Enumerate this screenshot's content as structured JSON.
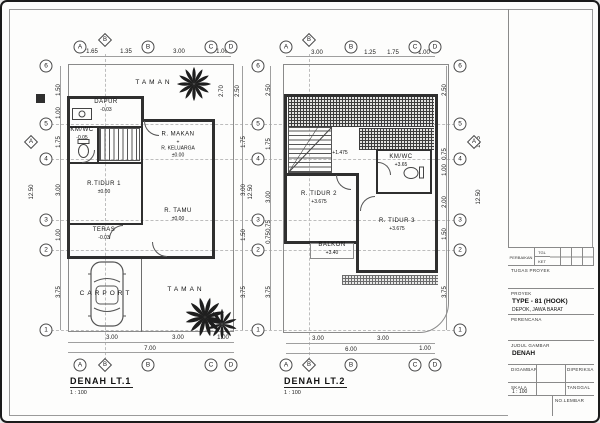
{
  "drawing": {
    "plans": [
      {
        "name": "floor-plan-level-1",
        "title": "DENAH LT.1",
        "scale": "1 : 100",
        "bubbles": [
          {
            "l": "A",
            "x": 78,
            "y": 45
          },
          {
            "l": "B",
            "x": 103,
            "y": 38,
            "d": 1
          },
          {
            "l": "B",
            "x": 146,
            "y": 45
          },
          {
            "l": "C",
            "x": 209,
            "y": 45
          },
          {
            "l": "D",
            "x": 229,
            "y": 45
          },
          {
            "l": "A",
            "x": 78,
            "y": 363
          },
          {
            "l": "B",
            "x": 103,
            "y": 363,
            "d": 1
          },
          {
            "l": "B",
            "x": 146,
            "y": 363
          },
          {
            "l": "C",
            "x": 209,
            "y": 363
          },
          {
            "l": "D",
            "x": 229,
            "y": 363
          },
          {
            "l": "6",
            "x": 44,
            "y": 64
          },
          {
            "l": "5",
            "x": 44,
            "y": 122
          },
          {
            "l": "A",
            "x": 29,
            "y": 140,
            "d": 1
          },
          {
            "l": "4",
            "x": 44,
            "y": 157
          },
          {
            "l": "3",
            "x": 44,
            "y": 218
          },
          {
            "l": "2",
            "x": 44,
            "y": 248
          },
          {
            "l": "1",
            "x": 44,
            "y": 328
          },
          {
            "l": "6",
            "x": 256,
            "y": 64
          },
          {
            "l": "5",
            "x": 256,
            "y": 122
          },
          {
            "l": "4",
            "x": 256,
            "y": 157
          },
          {
            "l": "3",
            "x": 256,
            "y": 218
          },
          {
            "l": "2",
            "x": 256,
            "y": 248
          },
          {
            "l": "1",
            "x": 256,
            "y": 328
          }
        ],
        "dims": [
          {
            "t": "1.65",
            "x": 90,
            "y": 50
          },
          {
            "t": "1.35",
            "x": 124,
            "y": 50
          },
          {
            "t": "3.00",
            "x": 177,
            "y": 50
          },
          {
            "t": "1.00",
            "x": 220,
            "y": 50
          },
          {
            "t": "3.00",
            "x": 110,
            "y": 336
          },
          {
            "t": "3.00",
            "x": 176,
            "y": 336
          },
          {
            "t": "1.00",
            "x": 221,
            "y": 336
          },
          {
            "t": "7.00",
            "x": 148,
            "y": 347
          },
          {
            "t": "1.50",
            "x": 57,
            "y": 88,
            "r": 1
          },
          {
            "t": "1.00",
            "x": 57,
            "y": 111,
            "r": 1
          },
          {
            "t": "1.75",
            "x": 57,
            "y": 140,
            "r": 1
          },
          {
            "t": "3.00",
            "x": 57,
            "y": 188,
            "r": 1
          },
          {
            "t": "1.00",
            "x": 57,
            "y": 233,
            "r": 1
          },
          {
            "t": "3.75",
            "x": 57,
            "y": 290,
            "r": 1
          },
          {
            "t": "12.50",
            "x": 30,
            "y": 190,
            "r": 1
          },
          {
            "t": "2.70",
            "x": 220,
            "y": 89,
            "r": 1
          },
          {
            "t": "2.50",
            "x": 236,
            "y": 89,
            "r": 1
          },
          {
            "t": "1.75",
            "x": 242,
            "y": 140,
            "r": 1
          },
          {
            "t": "3.00",
            "x": 242,
            "y": 188,
            "r": 1
          },
          {
            "t": "1.50",
            "x": 242,
            "y": 233,
            "r": 1
          },
          {
            "t": "3.75",
            "x": 242,
            "y": 290,
            "r": 1
          },
          {
            "t": "12.50",
            "x": 249,
            "y": 190,
            "r": 1
          }
        ],
        "labels": [
          {
            "x": 152,
            "y": 81,
            "lines": [
              "TAMAN"
            ],
            "cls": "garden"
          },
          {
            "x": 104,
            "y": 104,
            "lines": [
              "DAPUR",
              "-0.03"
            ]
          },
          {
            "x": 80,
            "y": 132,
            "lines": [
              "KM/WC",
              "-0.05"
            ]
          },
          {
            "x": 176,
            "y": 143,
            "lines": [
              "R. MAKAN",
              "+",
              "R. KELUARGA",
              "±0.00"
            ]
          },
          {
            "x": 102,
            "y": 186,
            "lines": [
              "R.TIDUR 1",
              "±0.00"
            ]
          },
          {
            "x": 176,
            "y": 213,
            "lines": [
              "R. TAMU",
              "±0.00"
            ]
          },
          {
            "x": 102,
            "y": 232,
            "lines": [
              "TERAS",
              "-0.03"
            ]
          },
          {
            "x": 104,
            "y": 292,
            "lines": [
              "CARPORT"
            ],
            "cls": "garden"
          },
          {
            "x": 184,
            "y": 288,
            "lines": [
              "TAMAN"
            ],
            "cls": "garden"
          }
        ]
      },
      {
        "name": "floor-plan-level-2",
        "title": "DENAH LT.2",
        "scale": "1 : 100",
        "bubbles": [
          {
            "l": "A",
            "x": 284,
            "y": 45
          },
          {
            "l": "B",
            "x": 307,
            "y": 38,
            "d": 1
          },
          {
            "l": "B",
            "x": 349,
            "y": 45
          },
          {
            "l": "C",
            "x": 413,
            "y": 45
          },
          {
            "l": "D",
            "x": 433,
            "y": 45
          },
          {
            "l": "A",
            "x": 284,
            "y": 363
          },
          {
            "l": "B",
            "x": 307,
            "y": 363,
            "d": 1
          },
          {
            "l": "B",
            "x": 349,
            "y": 363
          },
          {
            "l": "C",
            "x": 413,
            "y": 363
          },
          {
            "l": "D",
            "x": 433,
            "y": 363
          },
          {
            "l": "6",
            "x": 458,
            "y": 64
          },
          {
            "l": "5",
            "x": 458,
            "y": 122
          },
          {
            "l": "A",
            "x": 472,
            "y": 140,
            "d": 1
          },
          {
            "l": "4",
            "x": 458,
            "y": 157
          },
          {
            "l": "3",
            "x": 458,
            "y": 218
          },
          {
            "l": "2",
            "x": 458,
            "y": 248
          },
          {
            "l": "1",
            "x": 458,
            "y": 328
          }
        ],
        "dims": [
          {
            "t": "3.00",
            "x": 315,
            "y": 51
          },
          {
            "t": "1.25",
            "x": 368,
            "y": 51
          },
          {
            "t": "1.75",
            "x": 391,
            "y": 51
          },
          {
            "t": "1.00",
            "x": 422,
            "y": 51
          },
          {
            "t": "3.00",
            "x": 316,
            "y": 337
          },
          {
            "t": "3.00",
            "x": 381,
            "y": 337
          },
          {
            "t": "6.00",
            "x": 349,
            "y": 348
          },
          {
            "t": "1.00",
            "x": 423,
            "y": 347
          },
          {
            "t": "2.50",
            "x": 267,
            "y": 88,
            "r": 1
          },
          {
            "t": "1.75",
            "x": 267,
            "y": 142,
            "r": 1
          },
          {
            "t": "3.00",
            "x": 267,
            "y": 195,
            "r": 1
          },
          {
            "t": "0.75",
            "x": 267,
            "y": 224,
            "r": 1
          },
          {
            "t": "0.75",
            "x": 267,
            "y": 236,
            "r": 1
          },
          {
            "t": "3.75",
            "x": 267,
            "y": 290,
            "r": 1
          },
          {
            "t": "2.50",
            "x": 443,
            "y": 88,
            "r": 1
          },
          {
            "t": "0.75",
            "x": 443,
            "y": 152,
            "r": 1
          },
          {
            "t": "1.00",
            "x": 443,
            "y": 168,
            "r": 1
          },
          {
            "t": "2.00",
            "x": 443,
            "y": 200,
            "r": 1
          },
          {
            "t": "1.50",
            "x": 443,
            "y": 232,
            "r": 1
          },
          {
            "t": "3.75",
            "x": 443,
            "y": 290,
            "r": 1
          },
          {
            "t": "1.75",
            "x": 477,
            "y": 140,
            "r": 1
          },
          {
            "t": "12.50",
            "x": 477,
            "y": 195,
            "r": 1
          }
        ],
        "labels": [
          {
            "x": 338,
            "y": 151,
            "lines": [
              "+1.475"
            ]
          },
          {
            "x": 399,
            "y": 159,
            "lines": [
              "KM/WC",
              "+3.65"
            ]
          },
          {
            "x": 317,
            "y": 196,
            "lines": [
              "R. TIDUR 2",
              "+3.675"
            ]
          },
          {
            "x": 395,
            "y": 223,
            "lines": [
              "R. TIDUR 3",
              "+3.675"
            ]
          },
          {
            "x": 330,
            "y": 247,
            "lines": [
              "BALKON",
              "+3.40"
            ]
          }
        ]
      }
    ]
  },
  "titleblock": {
    "revision": {
      "col_label": "PERBAIKAN",
      "row1": "TGL",
      "row2": "KET"
    },
    "task_label": "TUGAS PROYEK",
    "project_label": "PROYEK",
    "project_name": "TYPE - 81 (HOOK)",
    "project_location": "DEPOK, JAWA BARAT",
    "designer_label": "PERENCANA",
    "drawing_title_label": "JUDUL GAMBAR",
    "drawing_title": "DENAH",
    "drawn_label": "DIGAMBAR",
    "checked_label": "DIPERIKSA",
    "approved_label": "DISETUJUI",
    "scale_label": "SKALA",
    "scale_value": "1 : 100",
    "date_label": "TANGGAL",
    "code_label": "KODE",
    "sheet_label": "NO.LEMBAR"
  }
}
